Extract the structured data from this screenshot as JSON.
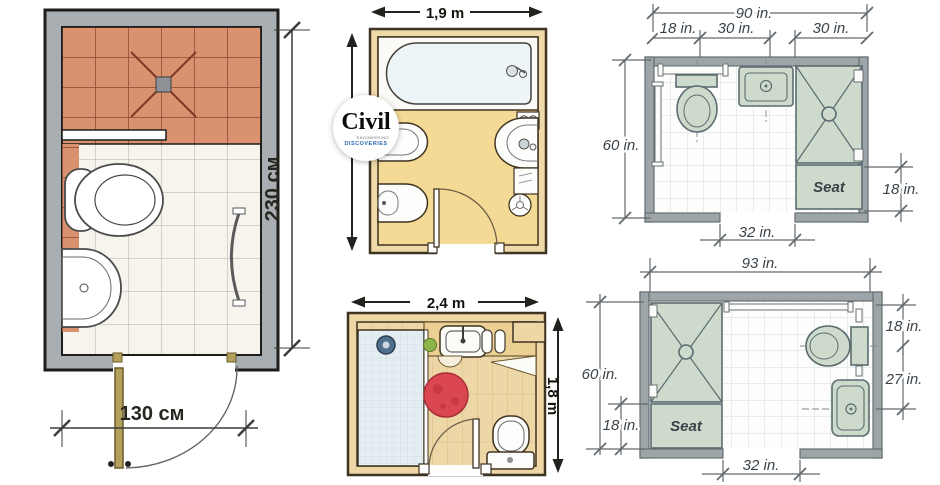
{
  "logo": {
    "name": "Civil",
    "tagline_top": "ENGINEERING",
    "tagline_bottom": "DISCOVERIES"
  },
  "plans": {
    "left_cm": {
      "width": "130 см",
      "height": "230 см"
    },
    "mid_top": {
      "width": "1,9 m"
    },
    "mid_bottom": {
      "width": "2,4 m",
      "height": "1,8 m"
    },
    "right_top": {
      "total_width": "90 in.",
      "toilet_zone": "18 in.",
      "sink_zone": "30 in.",
      "shower_zone": "30 in.",
      "height": "60 in.",
      "seat_depth": "18 in.",
      "door_width": "32 in.",
      "seat_label": "Seat"
    },
    "right_bottom": {
      "total_width": "93 in.",
      "height": "60 in.",
      "seat_depth": "18 in.",
      "toilet_centerline": "18 in.",
      "sink_centerline": "27 in.",
      "door_width": "32 in.",
      "seat_label": "Seat"
    }
  },
  "colors": {
    "wall_gray": "#9da5a9",
    "tile_salmon": "#d9916f",
    "floor_tan": "#f5da95",
    "wood_floor": "#eed7a7",
    "fixture_green": "#cedbcc",
    "rug_red": "#da4750",
    "accent_green": "#8cb449",
    "door_tan": "#b3a05c",
    "logo_blue": "#2a6ab0"
  }
}
